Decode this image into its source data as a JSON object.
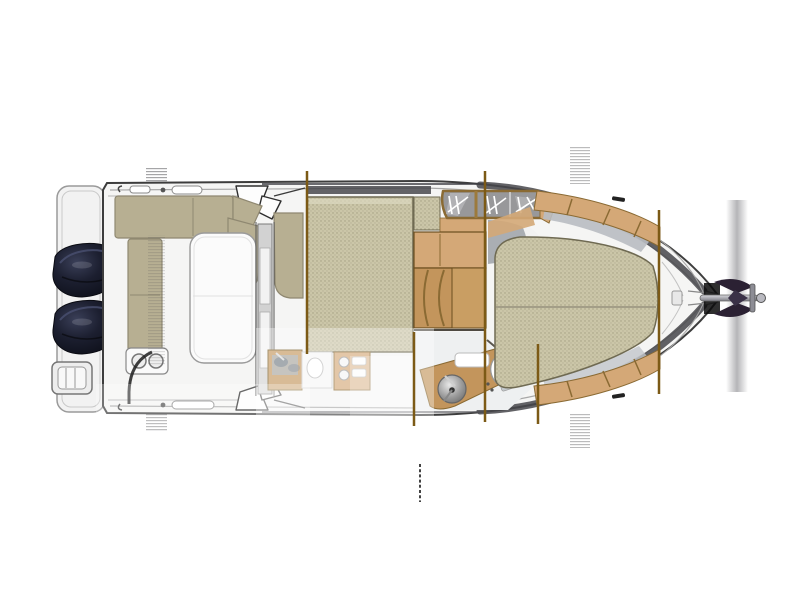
{
  "diagram": {
    "kind": "boat-floor-plan",
    "view": "top-down",
    "orientation": "bow-right-stern-left"
  },
  "parts": {
    "swim_platform": "swim-platform",
    "boarding_ladder": "boarding-ladder",
    "port_engine": "outboard-engine-port",
    "starboard_engine": "outboard-engine-starboard",
    "cockpit_bench_side": "cockpit-side-bench",
    "cockpit_bench_corner": "cockpit-corner-seat",
    "cockpit_bench_stern": "cockpit-stern-bench",
    "cupholders": "cupholder-module",
    "cockpit_table": "cockpit-table",
    "sliding_door": "wheelhouse-sliding-door",
    "wheelhouse_bench": "wheelhouse-aft-bench",
    "dinette_berth": "dinette-berth-cushion",
    "galley": "galley-counter",
    "companionway_steps": "companionway-steps",
    "windshield": "windshield-with-wipers",
    "head_compartment": "head-compartment",
    "washbasin": "washbasin",
    "toilet": "marine-toilet",
    "v_berth": "v-berth-cushion",
    "bow_trim": "bow-wood-trim",
    "anchor": "bow-anchor",
    "bulkhead_lines": "bulkhead-section-lines"
  },
  "colors": {
    "background": "#ffffff",
    "hull_fill": "#f5f5f4",
    "hull_outline": "#3d3d3d",
    "inner_rail": "#a8a8a8",
    "gunwale_dark": "#47474b",
    "deck_shadow": "#b9bdc2",
    "cushion_solid": "#b7af92",
    "cushion_textured_base": "#cbc6a8",
    "cushion_texture_dot": "#a49e81",
    "cushion_outline": "#6f6a52",
    "wood_light": "#d4a877",
    "wood_mid": "#c3955c",
    "wood_step": "#c99e63",
    "wood_dark": "#8a6a33",
    "bulkhead_line": "#7c5a16",
    "engine_body": "#12141f",
    "engine_highlight": "#4a5070",
    "windshield_glass": "#98989a",
    "wiper_white": "#ffffff",
    "table_white": "#fbfbfb",
    "fixture_grey": "#9aa0a4",
    "floor_white": "#eef0f1",
    "anchor_metal": "#8d8d95",
    "anchor_dark": "#2b2133",
    "streak_grey": "#4b4b4f",
    "ghost_white": "#ffffff"
  }
}
